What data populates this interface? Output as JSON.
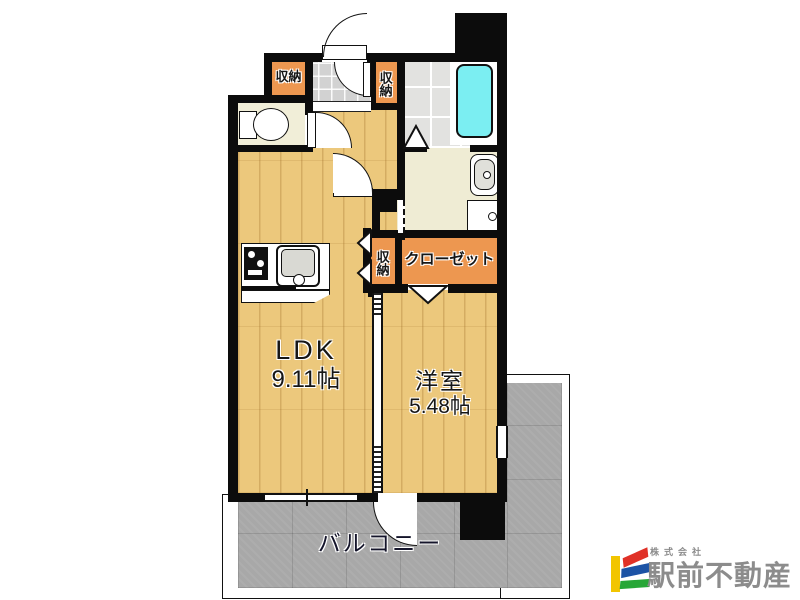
{
  "plan": {
    "title": "apartment floor plan",
    "rooms": {
      "ldk": {
        "name": "LDK",
        "area": "9.11帖"
      },
      "youshitsu": {
        "name": "洋室",
        "area": "5.48帖"
      },
      "balcony": {
        "name": "バルコニー"
      },
      "closet": {
        "name": "クローゼット"
      },
      "storage_entrance_left": {
        "name": "収納"
      },
      "storage_entrance_right": {
        "name": "収納"
      },
      "storage_hall": {
        "name": "収納"
      }
    },
    "colors": {
      "wall": "#0c0c0c",
      "wood_floor": "#ecc87c",
      "storage_orange": "#ed9750",
      "bathtub_cyan": "#7beef2",
      "balcony_gray": "#a8a8a8",
      "entry_tile_gray": "#d2d2d2",
      "bath_tile_gray": "#e2e2e0",
      "washroom_cream": "#efecd4"
    }
  },
  "logo": {
    "company_prefix": "株式会社",
    "company_name": "駅前不動産",
    "text_color": "#8c8c8c",
    "mark_colors": {
      "yellow": "#f2c500",
      "red": "#e03127",
      "blue": "#1c53a5",
      "green": "#27a737"
    }
  }
}
